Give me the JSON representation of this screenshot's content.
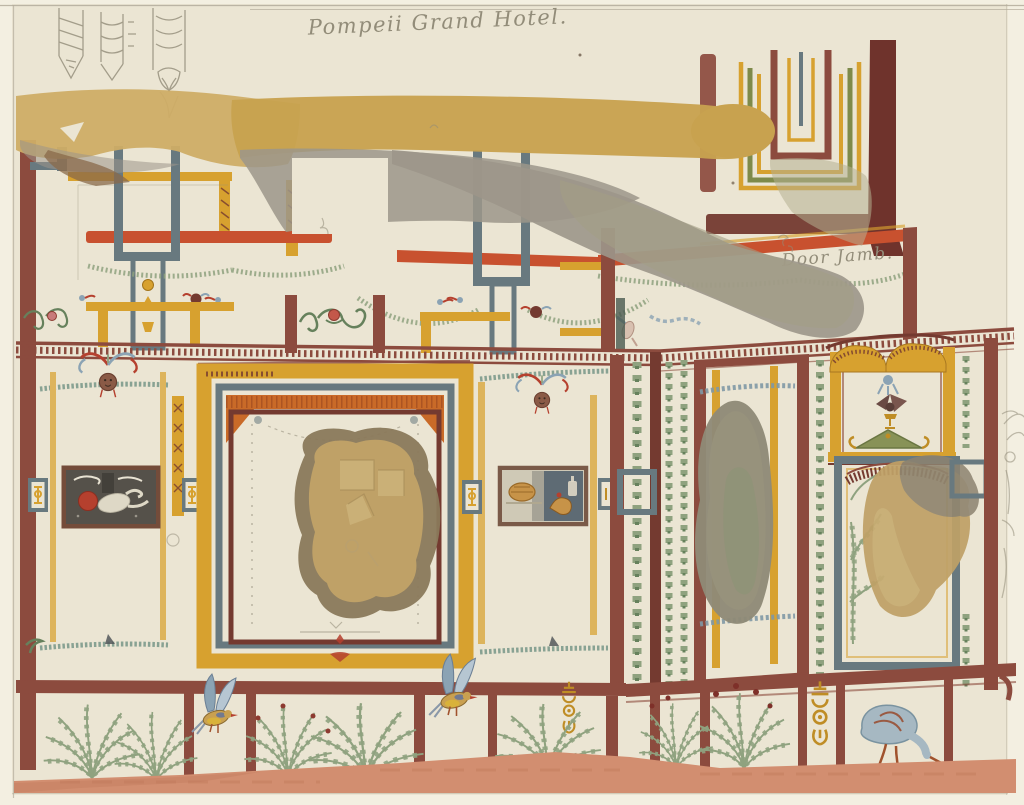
{
  "annotations": {
    "title": "Pompeii Grand Hotel.",
    "door_jamb": "Door Jamb."
  },
  "palette": {
    "paper": "#ebe5d3",
    "mat": "#f3efe1",
    "rule": "#b3ac9b",
    "pencil": "#928c79",
    "maroon": "#8c4b3e",
    "maroon_dark": "#743a30",
    "ochre": "#d7a12f",
    "ochre_light": "#ddb45c",
    "gold_orn": "#bf8d25",
    "tan_beam": "#c8a24f",
    "tan_wash": "#cfad66",
    "red_stripe": "#c8512f",
    "orange": "#c96a28",
    "blue_grey": "#68797f",
    "blue_light": "#8ba3b4",
    "steel": "#7f98a5",
    "teal": "#7d9a8c",
    "green": "#8fa27f",
    "green_dark": "#66815c",
    "olive": "#7e8a4a",
    "grey_wash": "#9c968a",
    "olive_wash": "#a49e86",
    "tan_blob": "#bfa167",
    "blob_edge": "#8a795b",
    "grey_blob": "#8f8a77",
    "salmon": "#d28e70",
    "salmon_dark": "#c07b5c",
    "red": "#b5402e",
    "dark_panel": "#55514a",
    "bird_body": "#c9a050"
  }
}
